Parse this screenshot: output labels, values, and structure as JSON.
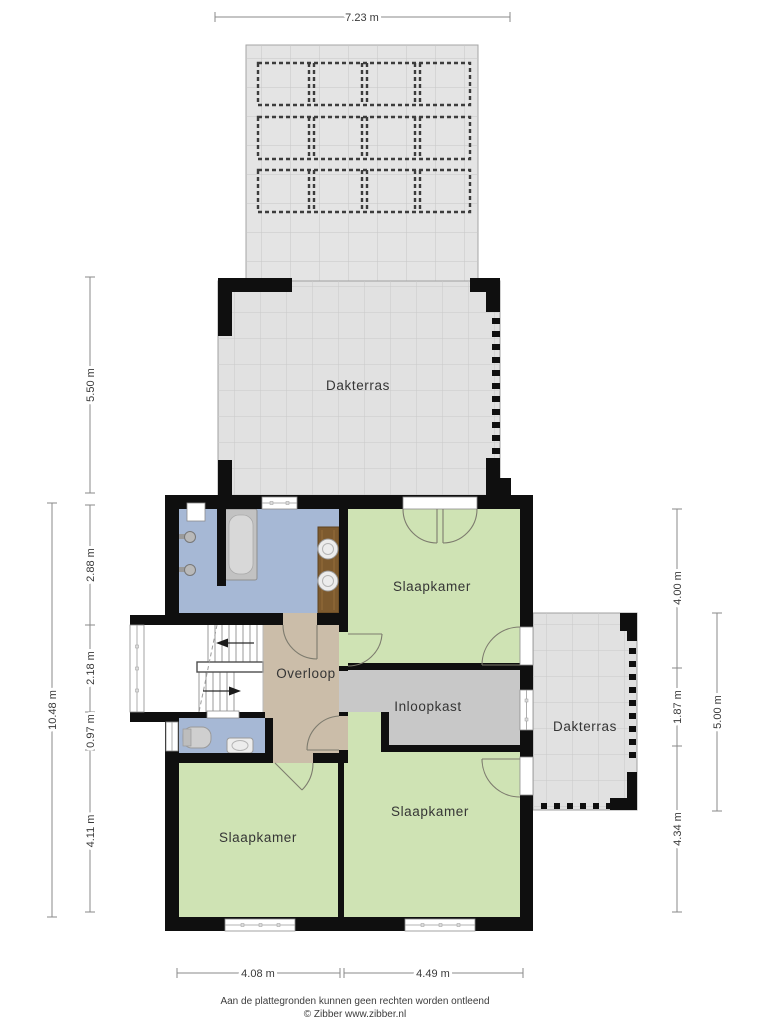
{
  "plan": {
    "type": "floorplan-second-floor",
    "rooms": {
      "dakterras_top": "Dakterras",
      "slaapkamer_top": "Slaapkamer",
      "overloop": "Overloop",
      "inloopkast": "Inloopkast",
      "dakterras_right": "Dakterras",
      "slaapkamer_bottom_left": "Slaapkamer",
      "slaapkamer_bottom_right": "Slaapkamer"
    },
    "fixtures": [
      "bathtub",
      "shower-heads",
      "double-sink-vanity",
      "toilet",
      "hand-basin",
      "staircase"
    ],
    "colors": {
      "wall": "#0f0f0f",
      "bedroom_green": "#cfe3b4",
      "bathroom_blue": "#a6b8d5",
      "landing_tan": "#cbbda9",
      "closet_gray": "#c8c8c8",
      "terrace_gray": "#e1e1e1",
      "wood_vanity": "#7d5a2e"
    }
  },
  "dimensions": {
    "top": "7.23 m",
    "left": [
      "5.50 m",
      "2.88 m",
      "2.18 m",
      "0.97 m",
      "4.11 m"
    ],
    "left_total": "10.48 m",
    "right": [
      "4.00 m",
      "1.87 m",
      "4.34 m"
    ],
    "right_outer": "5.00 m",
    "bottom": [
      "4.08 m",
      "4.49 m"
    ]
  },
  "footer": {
    "line1": "Aan de plattegronden kunnen geen rechten worden ontleend",
    "line2": "© Zibber www.zibber.nl"
  }
}
